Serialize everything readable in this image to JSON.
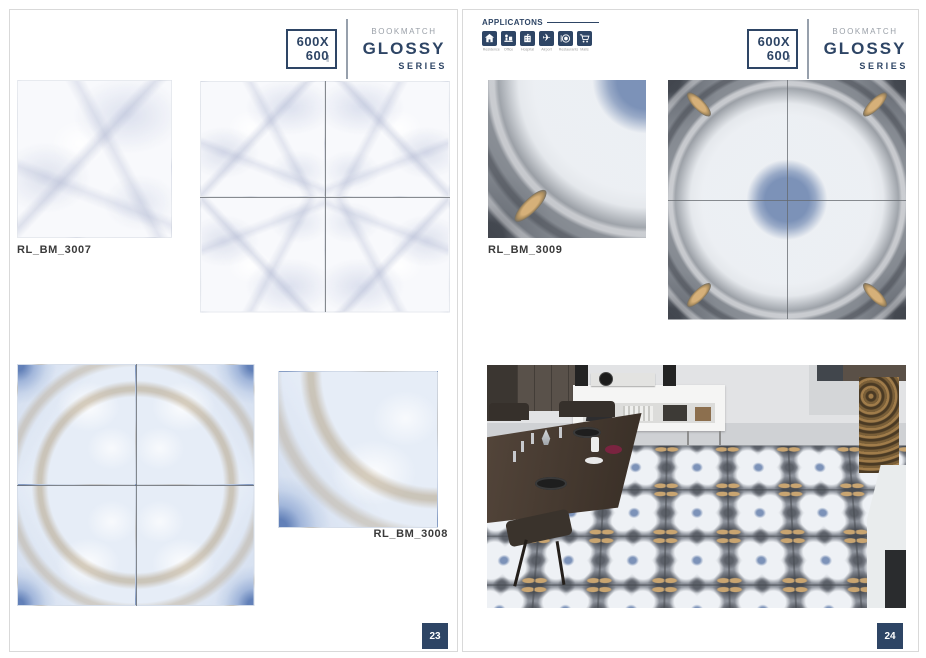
{
  "colors": {
    "accent_navy": "#2e4565",
    "collection_grey": "#9aa0a8",
    "label_dark": "#3a3a3a"
  },
  "left_page": {
    "series_header": {
      "size_top": "600X",
      "size_bottom": "600",
      "size_unit": "MM",
      "collection": "BOOKMATCH",
      "series": "GLOSSY",
      "series_sub": "SERIES"
    },
    "tiles": [
      {
        "code": "RL_BM_3007"
      },
      {
        "code": "RL_BM_3008"
      }
    ],
    "page_number": "23"
  },
  "right_page": {
    "applications": {
      "title": "APPLICATONS",
      "items": [
        {
          "icon": "house-icon",
          "label": "Residence"
        },
        {
          "icon": "office-icon",
          "label": "Office"
        },
        {
          "icon": "hospital-icon",
          "label": "Hospital"
        },
        {
          "icon": "airplane-icon",
          "label": "Airport"
        },
        {
          "icon": "restaurant-icon",
          "label": "Restaurants"
        },
        {
          "icon": "cart-icon",
          "label": "Malls"
        }
      ]
    },
    "series_header": {
      "size_top": "600X",
      "size_bottom": "600",
      "size_unit": "MM",
      "collection": "BOOKMATCH",
      "series": "GLOSSY",
      "series_sub": "SERIES"
    },
    "tiles": [
      {
        "code": "RL_BM_3009"
      }
    ],
    "page_number": "24"
  }
}
